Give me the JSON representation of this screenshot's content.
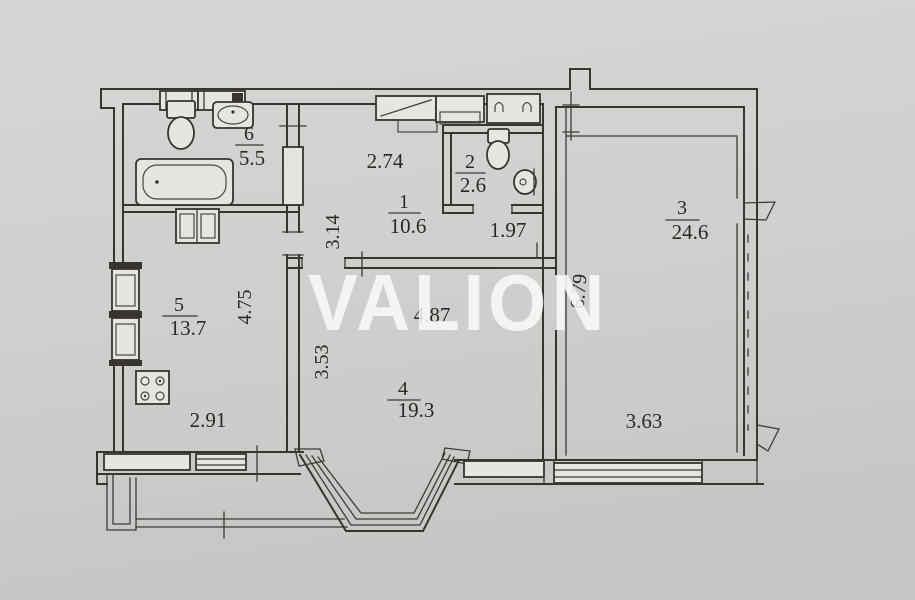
{
  "watermark": {
    "text": "VALION"
  },
  "rooms": [
    {
      "number": "1",
      "area": "10.6"
    },
    {
      "number": "2",
      "area": "2.6"
    },
    {
      "number": "3",
      "area": "24.6"
    },
    {
      "number": "4",
      "area": "19.3"
    },
    {
      "number": "5",
      "area": "13.7"
    },
    {
      "number": "6",
      "area": "5.5"
    }
  ],
  "dimensions": {
    "hall_width": "2.74",
    "hall_depth": "3.14",
    "wc_width": "1.97",
    "kitchen_depth": "4.75",
    "kitchen_width": "2.91",
    "room4_width": "4.87",
    "room4_left_depth": "3.53",
    "room3_depth": "6.79",
    "room3_bottom_width": "3.63"
  },
  "fixtures": [
    "bathtub",
    "toilet",
    "sink",
    "vent-shaft",
    "cabinet",
    "stove",
    "wardrobe",
    "shelf",
    "coat-hooks",
    "toilet",
    "sink",
    "window",
    "bay-window",
    "balcony-parapet"
  ],
  "colors": {
    "paper": "#d2d1cf",
    "ink": "#38352f",
    "watermark": "#ffffff"
  }
}
